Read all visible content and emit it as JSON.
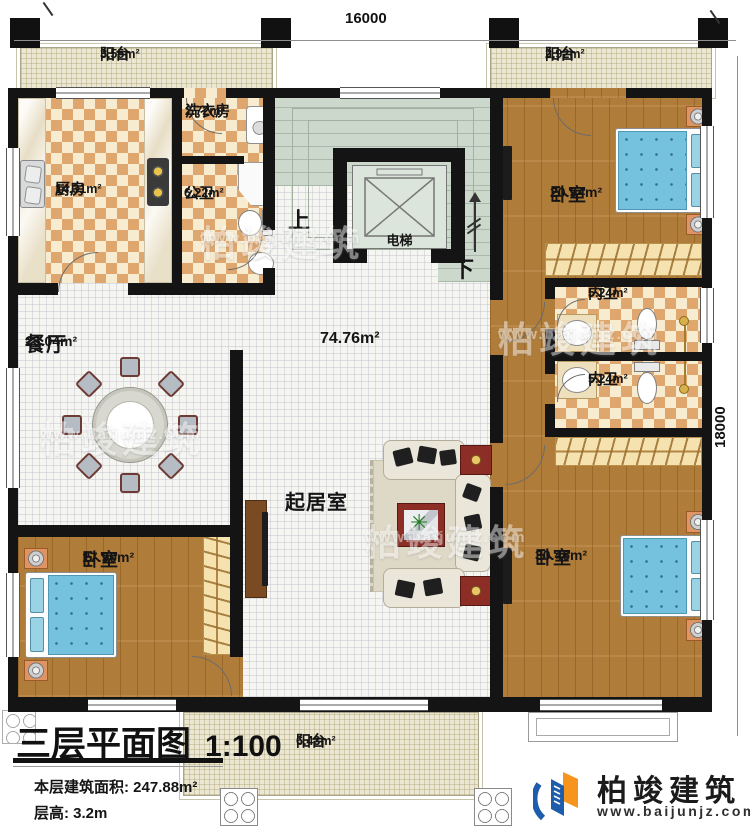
{
  "dimensions": {
    "width_mm": "16000",
    "depth_mm": "18000"
  },
  "rooms": {
    "balcony_tl": {
      "name": "阳台",
      "area": "3.55m²"
    },
    "balcony_tr": {
      "name": "阳台",
      "area": "2.92m²"
    },
    "balcony_bottom": {
      "name": "阳台",
      "area": "6.43m²"
    },
    "kitchen": {
      "name": "厨房",
      "area": "14.31m²"
    },
    "laundry": {
      "name": "洗衣房",
      "area": "2.72m²"
    },
    "public_bath": {
      "name": "公卫",
      "area": "6.22m²"
    },
    "bedroom_tr": {
      "name": "卧室",
      "area": "20.94m²"
    },
    "inner_bath_1": {
      "name": "内卫",
      "area": "5.24m²"
    },
    "inner_bath_2": {
      "name": "内卫",
      "area": "5.24m²"
    },
    "dining": {
      "name": "餐厅",
      "area": "25.04m²"
    },
    "living": {
      "name": "起居室"
    },
    "hall": {
      "area": "74.76m²"
    },
    "bedroom_bl": {
      "name": "卧室",
      "area": "17.90m²"
    },
    "bedroom_br": {
      "name": "卧室",
      "area": "30.46m²"
    }
  },
  "annotations": {
    "stairs_up": "上",
    "stairs_down": "下",
    "elevator": "电梯"
  },
  "title_block": {
    "title": "三层平面图",
    "scale": "1:100",
    "floor_area": "本层建筑面积: 247.88m²",
    "floor_height": "层高: 3.2m"
  },
  "brand": {
    "name": "柏竣建筑",
    "website": "www.baijunjz.com"
  },
  "watermark": {
    "name": "柏竣建筑",
    "website": "www.baijunjz.com"
  },
  "colors": {
    "wall": "#141414",
    "checker_dark": "#dfa76d",
    "wood": "#b07c3a",
    "stair_green": "#cdd8cd",
    "bed_blue": "#74c2de",
    "brand_blue": "#1d5dab",
    "brand_orange": "#f7941d"
  }
}
